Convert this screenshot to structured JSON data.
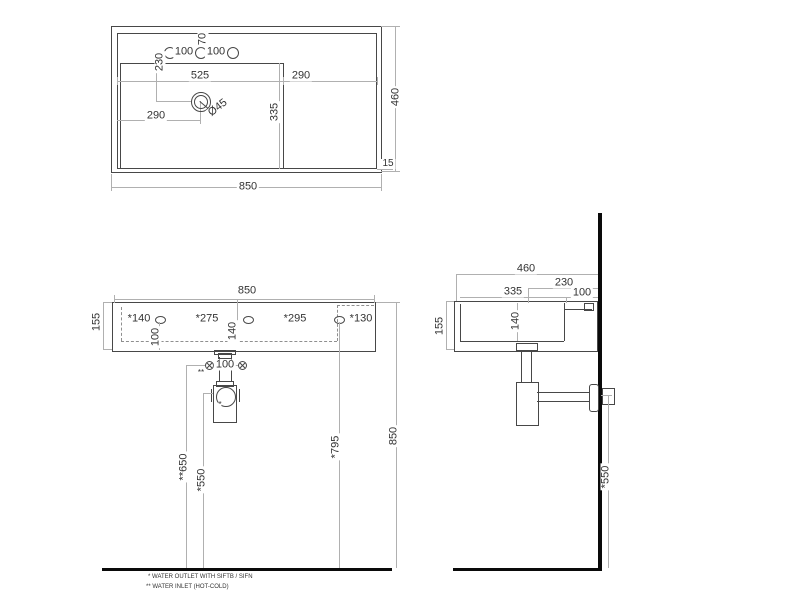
{
  "title": "washbasin-technical-drawing",
  "colors": {
    "bg": "#ffffff",
    "line": "#474747",
    "dim": "#b0b0b0",
    "text": "#333333",
    "thick": "#0a0a0a"
  },
  "icons": {
    "water_inlet": "circled-x-icon",
    "faucet_hole": "circle-icon",
    "drain": "concentric-circles-icon"
  },
  "top_view": {
    "overall_width": "850",
    "overall_depth": "460",
    "rim_gap": "15",
    "hole_pitch_left": "100",
    "hole_pitch_right": "100",
    "hole_offset": "70",
    "drain_setback": "230",
    "bowl_width": "525",
    "deck_width": "290",
    "drain_from_left": "290",
    "bowl_depth": "335",
    "drain_diameter": "Ø45"
  },
  "front_view": {
    "overall_width": "850",
    "height": "155",
    "hole_spacing": [
      "*140",
      "*275",
      "*295",
      "*130"
    ],
    "hole_height": "100",
    "bowl_inner_depth": "140",
    "inlet_spacing": "100",
    "inlet_ref": "**",
    "outlet_ref": "*",
    "inlet_height": "**650",
    "outlet_height": "*550",
    "right_hole_height": "*795",
    "rim_height": "850"
  },
  "side_view": {
    "overall_depth": "460",
    "drain_setback": "230",
    "bowl_depth": "335",
    "deck_depth": "100",
    "height": "155",
    "bowl_inner_depth": "140",
    "outlet_height": "*550"
  },
  "notes": {
    "outlet": "* WATER OUTLET WITH SIFTB / SIFN",
    "inlet": "** WATER INLET  (HOT-COLD)"
  }
}
